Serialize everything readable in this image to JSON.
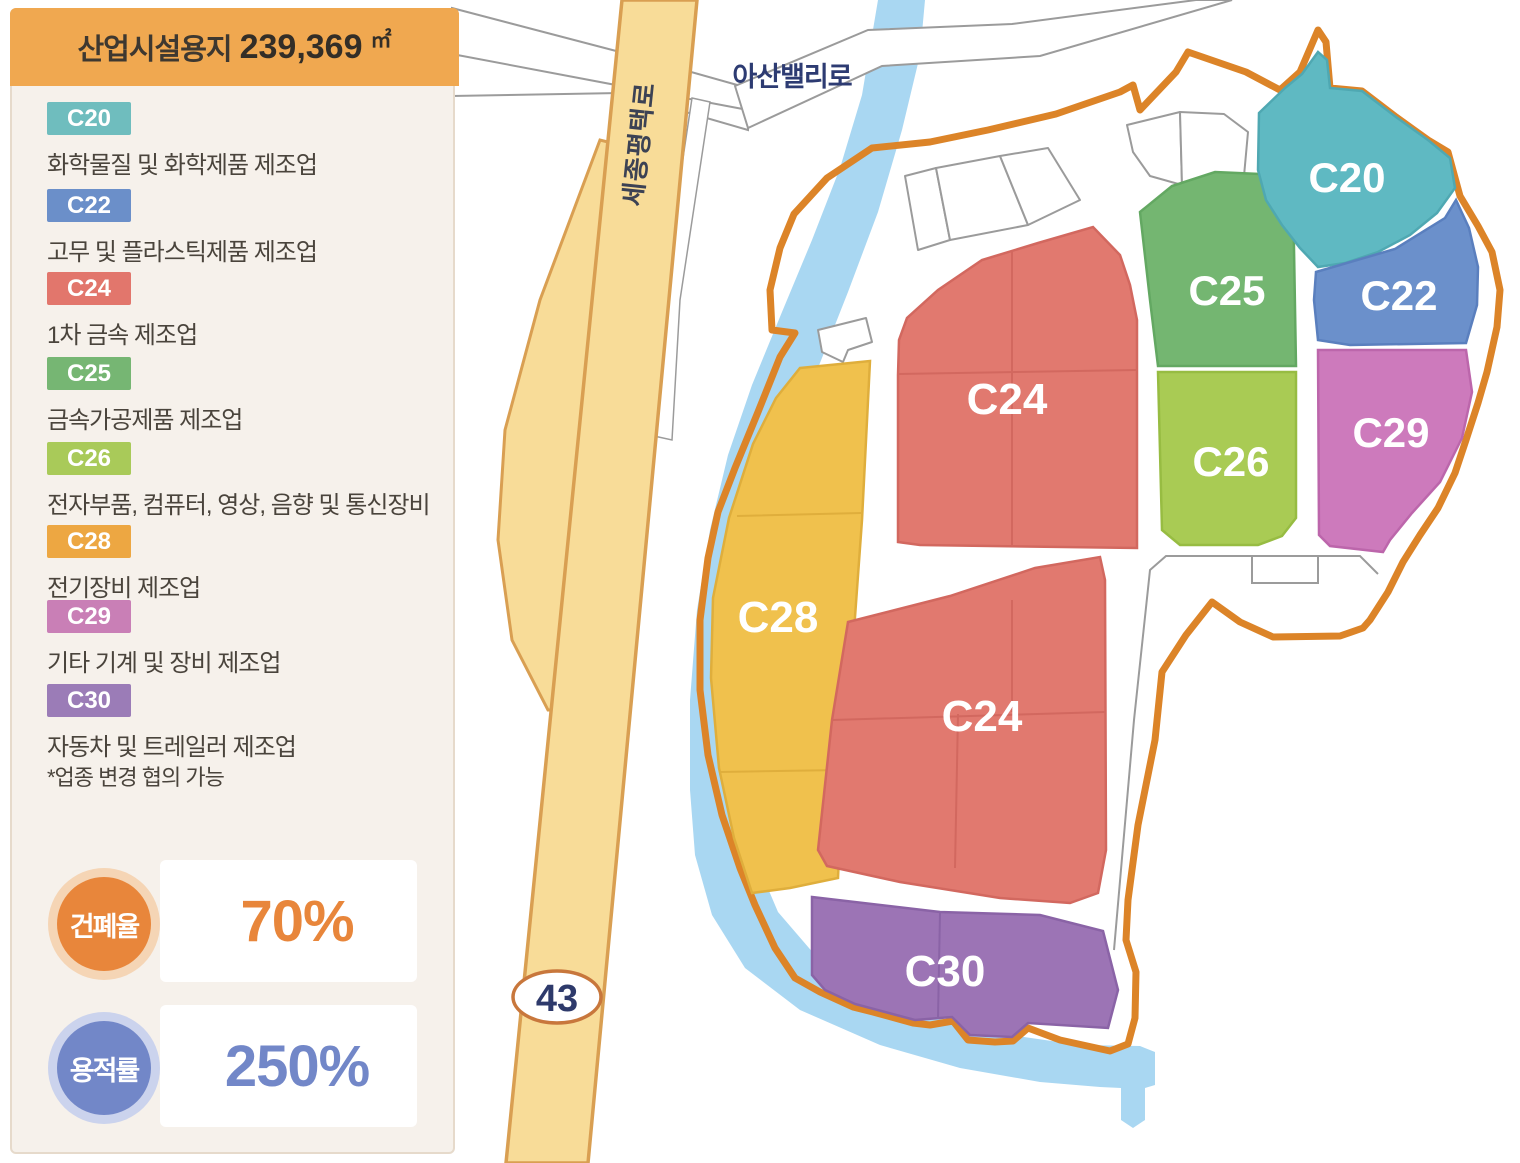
{
  "panel": {
    "title": "산업시설용지",
    "area_value": "239,369",
    "area_unit": "㎡",
    "legend": [
      {
        "code": "C20",
        "desc": "화학물질 및 화학제품 제조업",
        "color": "#6FBDBE"
      },
      {
        "code": "C22",
        "desc": "고무 및 플라스틱제품 제조업",
        "color": "#6B8FC9"
      },
      {
        "code": "C24",
        "desc": "1차 금속 제조업",
        "color": "#E2766C"
      },
      {
        "code": "C25",
        "desc": "금속가공제품 제조업",
        "color": "#76B673"
      },
      {
        "code": "C26",
        "desc": "전자부품, 컴퓨터, 영상, 음향 및 통신장비",
        "color": "#A9CA59"
      },
      {
        "code": "C28",
        "desc": "전기장비 제조업",
        "color": "#EDA742"
      },
      {
        "code": "C29",
        "desc": "기타 기계 및 장비 제조업",
        "color": "#C97FB6"
      },
      {
        "code": "C30",
        "desc": "자동차 및 트레일러 제조업",
        "color": "#9B7CB7"
      }
    ],
    "note": "*업종 변경 협의 가능",
    "stats": [
      {
        "label": "건폐율",
        "value": "70%",
        "color": "#E8863B"
      },
      {
        "label": "용적률",
        "value": "250%",
        "color": "#7287C8"
      }
    ]
  },
  "map": {
    "road_labels": {
      "asan_valley": "아산밸리로",
      "sejong_pyeongtaek": "세종평택로"
    },
    "route_badge": "43",
    "zones": [
      {
        "code": "C20",
        "color": "#5FB9C2"
      },
      {
        "code": "C22",
        "color": "#6B90CB"
      },
      {
        "code": "C24",
        "color": "#E1796F"
      },
      {
        "code": "C25",
        "color": "#74B671"
      },
      {
        "code": "C26",
        "color": "#A9CB54"
      },
      {
        "code": "C28",
        "color": "#F0C14D"
      },
      {
        "code": "C29",
        "color": "#CD7ABC"
      },
      {
        "code": "C30",
        "color": "#9C74B5"
      }
    ]
  }
}
